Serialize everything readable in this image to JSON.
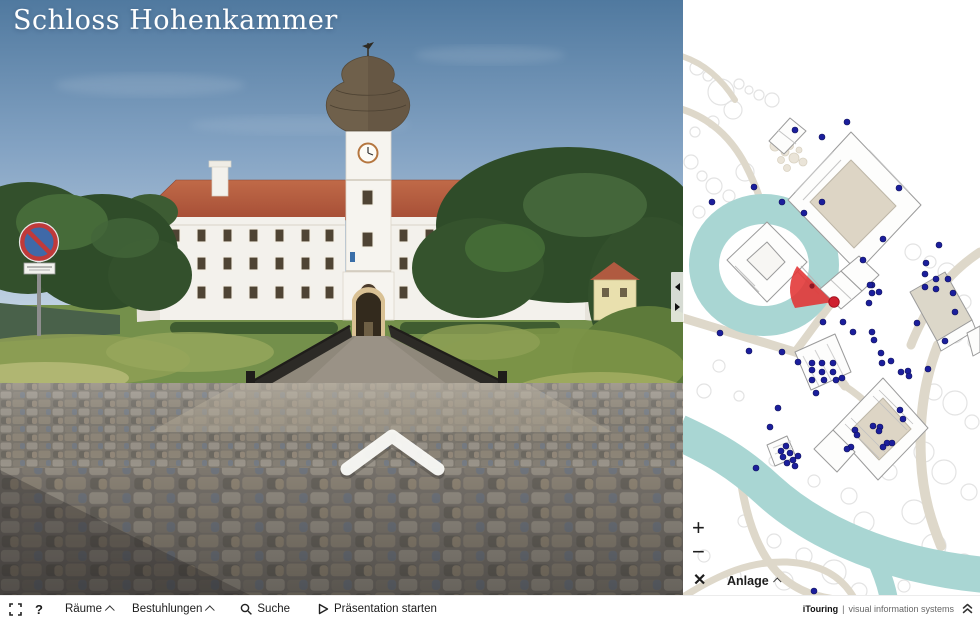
{
  "title": "Schloss Hohenkammer",
  "toolbar": {
    "help": "?",
    "rooms": "Räume",
    "seating": "Bestuhlungen",
    "search": "Suche",
    "presentation": "Präsentation starten",
    "brand_name": "iTouring",
    "brand_sep": "|",
    "brand_tagline": "visual information systems"
  },
  "map": {
    "zoom_in": "+",
    "zoom_out": "−",
    "close": "✕",
    "layer": "Anlage",
    "water_color": "#a9d6d3",
    "path_color": "#ded8ca",
    "poi_color": "#1b1e9c",
    "view_cone_color": "#e23333",
    "position_dot_color": "#cf1f2e",
    "poi_dots": [
      [
        112,
        130
      ],
      [
        139,
        137
      ],
      [
        164,
        122
      ],
      [
        71,
        187
      ],
      [
        29,
        202
      ],
      [
        99,
        202
      ],
      [
        121,
        213
      ],
      [
        139,
        202
      ],
      [
        216,
        188
      ],
      [
        200,
        239
      ],
      [
        256,
        245
      ],
      [
        180,
        260
      ],
      [
        243,
        263
      ],
      [
        253,
        279
      ],
      [
        265,
        279
      ],
      [
        189,
        285
      ],
      [
        242,
        287
      ],
      [
        187,
        285
      ],
      [
        196,
        292
      ],
      [
        189,
        293
      ],
      [
        186,
        303
      ],
      [
        140,
        322
      ],
      [
        160,
        322
      ],
      [
        170,
        332
      ],
      [
        189,
        332
      ],
      [
        191,
        340
      ],
      [
        242,
        274
      ],
      [
        253,
        289
      ],
      [
        270,
        293
      ],
      [
        272,
        312
      ],
      [
        234,
        323
      ],
      [
        262,
        341
      ],
      [
        129,
        363
      ],
      [
        139,
        363
      ],
      [
        150,
        363
      ],
      [
        129,
        370
      ],
      [
        139,
        372
      ],
      [
        150,
        372
      ],
      [
        129,
        380
      ],
      [
        141,
        380
      ],
      [
        153,
        380
      ],
      [
        159,
        378
      ],
      [
        37,
        333
      ],
      [
        66,
        351
      ],
      [
        99,
        352
      ],
      [
        115,
        362
      ],
      [
        198,
        353
      ],
      [
        208,
        361
      ],
      [
        199,
        363
      ],
      [
        218,
        372
      ],
      [
        225,
        371
      ],
      [
        226,
        376
      ],
      [
        245,
        369
      ],
      [
        217,
        410
      ],
      [
        220,
        419
      ],
      [
        190,
        426
      ],
      [
        197,
        427
      ],
      [
        196,
        431
      ],
      [
        204,
        443
      ],
      [
        209,
        443
      ],
      [
        200,
        447
      ],
      [
        172,
        430
      ],
      [
        174,
        435
      ],
      [
        168,
        447
      ],
      [
        164,
        449
      ],
      [
        133,
        393
      ],
      [
        95,
        408
      ],
      [
        87,
        427
      ],
      [
        103,
        446
      ],
      [
        107,
        453
      ],
      [
        98,
        451
      ],
      [
        100,
        457
      ],
      [
        110,
        460
      ],
      [
        115,
        456
      ],
      [
        104,
        463
      ],
      [
        112,
        466
      ],
      [
        73,
        468
      ],
      [
        131,
        591
      ]
    ]
  }
}
